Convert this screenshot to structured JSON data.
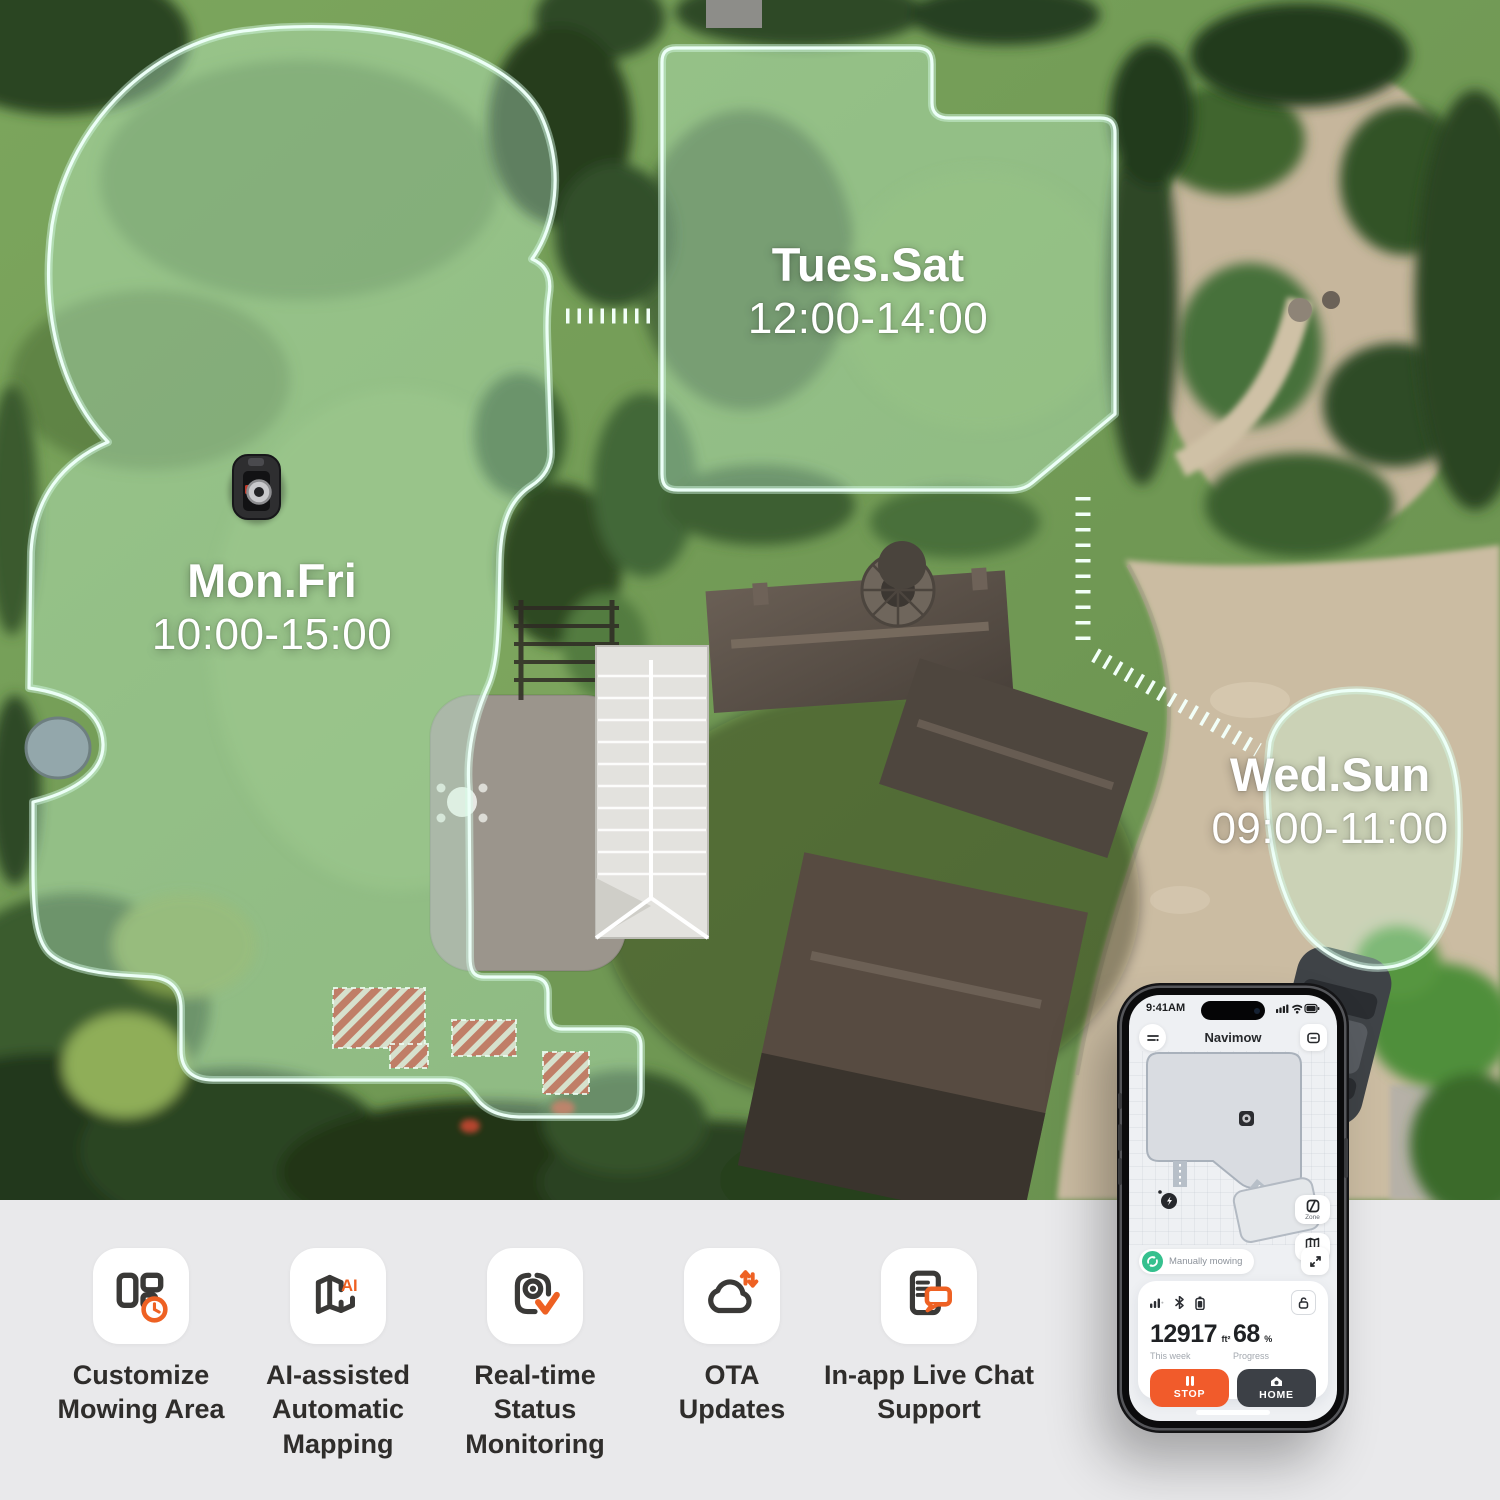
{
  "hero": {
    "zones": [
      {
        "days": "Mon.Fri",
        "time": "10:00-15:00"
      },
      {
        "days": "Tues.Sat",
        "time": "12:00-14:00"
      },
      {
        "days": "Wed.Sun",
        "time": "09:00-11:00"
      }
    ]
  },
  "phone": {
    "status_time": "9:41AM",
    "app_title": "Navimow",
    "map": {
      "zone_button_label": "Zone",
      "area_button_label": "2600m²",
      "status_pill": "Manually mowing"
    },
    "stats": {
      "area_value": "12917",
      "area_unit": "ft²",
      "area_caption": "This week",
      "progress_value": "68",
      "progress_unit": "%",
      "progress_caption": "Progress"
    },
    "actions": {
      "stop_label": "STOP",
      "home_label": "HOME"
    }
  },
  "features": [
    {
      "label": "Customize Mowing Area",
      "icon": "mowing-area-clock-icon"
    },
    {
      "label": "AI-assisted Automatic Mapping",
      "icon": "ai-map-icon"
    },
    {
      "label": "Real-time Status Monitoring",
      "icon": "status-monitor-check-icon"
    },
    {
      "label": "OTA Updates",
      "icon": "cloud-update-icon"
    },
    {
      "label": "In-app Live Chat Support",
      "icon": "live-chat-icon"
    }
  ],
  "colors": {
    "accent_orange": "#f15b2b",
    "pill_green": "#35c08e",
    "zone_outline": "#ecfff7",
    "strip_bg": "#e9e9eb"
  }
}
